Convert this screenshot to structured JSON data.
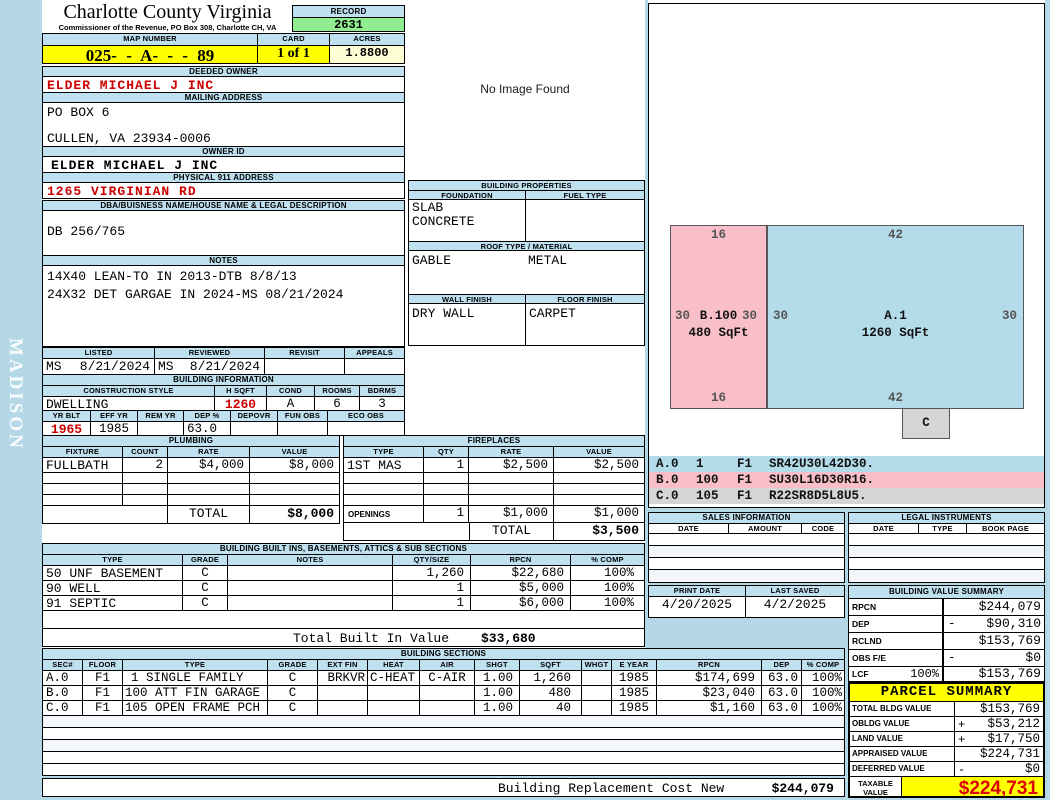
{
  "colors": {
    "page_bg": "#b5d8e6",
    "header_bar": "#bfe0ee",
    "highlight_yellow": "#ffff00",
    "record_green": "#90ee90",
    "acres_cream": "#ffffd6",
    "alert_red": "#cc0000",
    "sketch_pink": "#f9bfc9",
    "sketch_blue": "#b3dbe9",
    "sketch_grey": "#d5d5d5"
  },
  "sidebar": {
    "vertical_text": "MADISON"
  },
  "header": {
    "county_title": "Charlotte County Virginia",
    "county_subtitle": "Commissioner of the Revenue, PO Box 308, Charlotte CH, VA",
    "record_label": "RECORD",
    "record_value": "2631",
    "map_label": "MAP NUMBER",
    "map_value": "025- - A- - - 89",
    "card_label": "CARD",
    "card_value": "1 of 1",
    "acres_label": "ACRES",
    "acres_value": "1.8800"
  },
  "owner": {
    "deeded_label": "DEEDED OWNER",
    "deeded_value": "ELDER MICHAEL J INC",
    "mailing_label": "MAILING ADDRESS",
    "mailing_line1": "PO BOX 6",
    "mailing_line2": "CULLEN, VA 23934-0006",
    "ownerid_label": "OWNER ID",
    "ownerid_value": "ELDER MICHAEL J INC",
    "physical_label": "PHYSICAL 911 ADDRESS",
    "physical_value": "1265 VIRGINIAN RD",
    "dba_label": "DBA/BUISNESS NAME/HOUSE NAME & LEGAL DESCRIPTION",
    "dba_value": "DB 256/765",
    "notes_label": "NOTES",
    "notes_line1": "14X40 LEAN-TO IN 2013-DTB 8/8/13",
    "notes_line2": "24X32 DET GARGAE IN 2024-MS 08/21/2024"
  },
  "visits": {
    "labels": [
      "LISTED",
      "REVIEWED",
      "REVISIT",
      "APPEALS"
    ],
    "listed_by": "MS",
    "listed_date": "8/21/2024",
    "reviewed_by": "MS",
    "reviewed_date": "8/21/2024",
    "revisit": "",
    "appeals": ""
  },
  "building_info": {
    "title": "BUILDING INFORMATION",
    "style_headers": [
      "CONSTRUCTION STYLE",
      "H SQFT",
      "COND",
      "ROOMS",
      "BDRMS"
    ],
    "style": "DWELLING",
    "h_sqft": "1260",
    "cond": "A",
    "rooms": "6",
    "bdrms": "3",
    "year_headers": [
      "YR BLT",
      "EFF YR",
      "REM YR",
      "DEP %",
      "DEPOVR",
      "FUN OBS",
      "ECO OBS"
    ],
    "yr_blt": "1965",
    "eff_yr": "1985",
    "rem_yr": "",
    "dep_pct": "63.0",
    "depovr": "",
    "fun_obs": "",
    "eco_obs": ""
  },
  "no_image": {
    "text": "No Image Found"
  },
  "properties": {
    "title": "BUILDING PROPERTIES",
    "foundation_label": "FOUNDATION",
    "fuel_label": "FUEL TYPE",
    "foundation_line1": "SLAB",
    "foundation_line2": "CONCRETE",
    "fuel_value": "",
    "roof_label": "ROOF TYPE / MATERIAL",
    "roof_type": "GABLE",
    "roof_material": "METAL",
    "wall_label": "WALL FINISH",
    "floor_label": "FLOOR FINISH",
    "wall_value": "DRY WALL",
    "floor_value": "CARPET"
  },
  "plumbing": {
    "title": "PLUMBING",
    "headers": [
      "FIXTURE",
      "COUNT",
      "RATE",
      "VALUE"
    ],
    "fixture": "FULLBATH",
    "count": "2",
    "rate": "$4,000",
    "value": "$8,000",
    "total_label": "TOTAL",
    "total": "$8,000"
  },
  "fireplaces": {
    "title": "FIREPLACES",
    "headers": [
      "TYPE",
      "QTY",
      "RATE",
      "VALUE"
    ],
    "type": "1ST MAS",
    "qty": "1",
    "rate": "$2,500",
    "value": "$2,500",
    "openings_label": "OPENINGS",
    "openings_qty": "1",
    "openings_rate": "$1,000",
    "openings_value": "$1,000",
    "total_label": "TOTAL",
    "total": "$3,500"
  },
  "builtins": {
    "title": "BUILDING BUILT INS, BASEMENTS, ATTICS & SUB SECTIONS",
    "headers": [
      "TYPE",
      "GRADE",
      "NOTES",
      "QTY/SIZE",
      "RPCN",
      "% COMP"
    ],
    "rows": [
      {
        "type": "50 UNF BASEMENT",
        "grade": "C",
        "notes": "",
        "qty": "1,260",
        "rpcn": "$22,680",
        "comp": "100%"
      },
      {
        "type": "90 WELL",
        "grade": "C",
        "notes": "",
        "qty": "1",
        "rpcn": "$5,000",
        "comp": "100%"
      },
      {
        "type": "91 SEPTIC",
        "grade": "C",
        "notes": "",
        "qty": "1",
        "rpcn": "$6,000",
        "comp": "100%"
      }
    ],
    "total_label": "Total Built In Value",
    "total": "$33,680"
  },
  "sections": {
    "title": "BUILDING SECTIONS",
    "headers": [
      "SEC#",
      "FLOOR",
      "TYPE",
      "GRADE",
      "EXT FIN",
      "HEAT",
      "AIR",
      "SHGT",
      "SQFT",
      "WHGT",
      "E YEAR",
      "RPCN",
      "DEP",
      "% COMP"
    ],
    "rows": [
      {
        "sec": "A.0",
        "floor": "F1",
        "type": "1 SINGLE FAMILY",
        "grade": "C",
        "extfin": "BRKVR",
        "heat": "C-HEAT",
        "air": "C-AIR",
        "shgt": "1.00",
        "sqft": "1,260",
        "whgt": "",
        "eyear": "1985",
        "rpcn": "$174,699",
        "dep": "63.0",
        "comp": "100%"
      },
      {
        "sec": "B.0",
        "floor": "F1",
        "type": "100 ATT FIN GARAGE",
        "grade": "C",
        "extfin": "",
        "heat": "",
        "air": "",
        "shgt": "1.00",
        "sqft": "480",
        "whgt": "",
        "eyear": "1985",
        "rpcn": "$23,040",
        "dep": "63.0",
        "comp": "100%"
      },
      {
        "sec": "C.0",
        "floor": "F1",
        "type": "105 OPEN FRAME PCH",
        "grade": "C",
        "extfin": "",
        "heat": "",
        "air": "",
        "shgt": "1.00",
        "sqft": "40",
        "whgt": "",
        "eyear": "1985",
        "rpcn": "$1,160",
        "dep": "63.0",
        "comp": "100%"
      }
    ],
    "footer_label": "Building Replacement Cost New",
    "footer_value": "$244,079"
  },
  "sketch": {
    "a": {
      "name": "A.1",
      "area": "1260 SqFt",
      "top": "42",
      "bottom": "42",
      "left": "30",
      "right": "30"
    },
    "b": {
      "name": "B.100",
      "area": "480 SqFt",
      "top": "16",
      "bottom": "16",
      "left": "30",
      "right": "30"
    },
    "c_label": "C",
    "legend": [
      {
        "sec": "A.0",
        "code": "1",
        "floor": "F1",
        "vector": "SR42U30L42D30."
      },
      {
        "sec": "B.0",
        "code": "100",
        "floor": "F1",
        "vector": "SU30L16D30R16."
      },
      {
        "sec": "C.0",
        "code": "105",
        "floor": "F1",
        "vector": "R22SR8D5L8U5."
      }
    ]
  },
  "sales": {
    "title": "SALES INFORMATION",
    "headers": [
      "DATE",
      "AMOUNT",
      "CODE"
    ]
  },
  "legal": {
    "title": "LEGAL INSTRUMENTS",
    "headers": [
      "DATE",
      "TYPE",
      "BOOK PAGE"
    ]
  },
  "dates": {
    "print_label": "PRINT DATE",
    "print_value": "4/20/2025",
    "saved_label": "LAST SAVED",
    "saved_value": "4/2/2025"
  },
  "value_summary": {
    "title": "BUILDING VALUE SUMMARY",
    "rows": [
      {
        "label": "RPCN",
        "pct": "",
        "op": "",
        "value": "$244,079"
      },
      {
        "label": "DEP",
        "pct": "",
        "op": "-",
        "value": "$90,310"
      },
      {
        "label": "RCLND",
        "pct": "",
        "op": "",
        "value": "$153,769"
      },
      {
        "label": "OBS F/E",
        "pct": "",
        "op": "-",
        "value": "$0"
      },
      {
        "label": "LCF",
        "pct": "100%",
        "op": "",
        "value": "$153,769"
      }
    ]
  },
  "parcel": {
    "title": "PARCEL SUMMARY",
    "rows": [
      {
        "label": "TOTAL BLDG VALUE",
        "op": "",
        "value": "$153,769"
      },
      {
        "label": "OBLDG VALUE",
        "op": "+",
        "value": "$53,212"
      },
      {
        "label": "LAND VALUE",
        "op": "+",
        "value": "$17,750"
      },
      {
        "label": "APPRAISED VALUE",
        "op": "",
        "value": "$224,731"
      },
      {
        "label": "DEFERRED VALUE",
        "op": "-",
        "value": "$0"
      }
    ],
    "taxable_line1": "TAXABLE",
    "taxable_line2": "VALUE",
    "taxable_value": "$224,731"
  }
}
